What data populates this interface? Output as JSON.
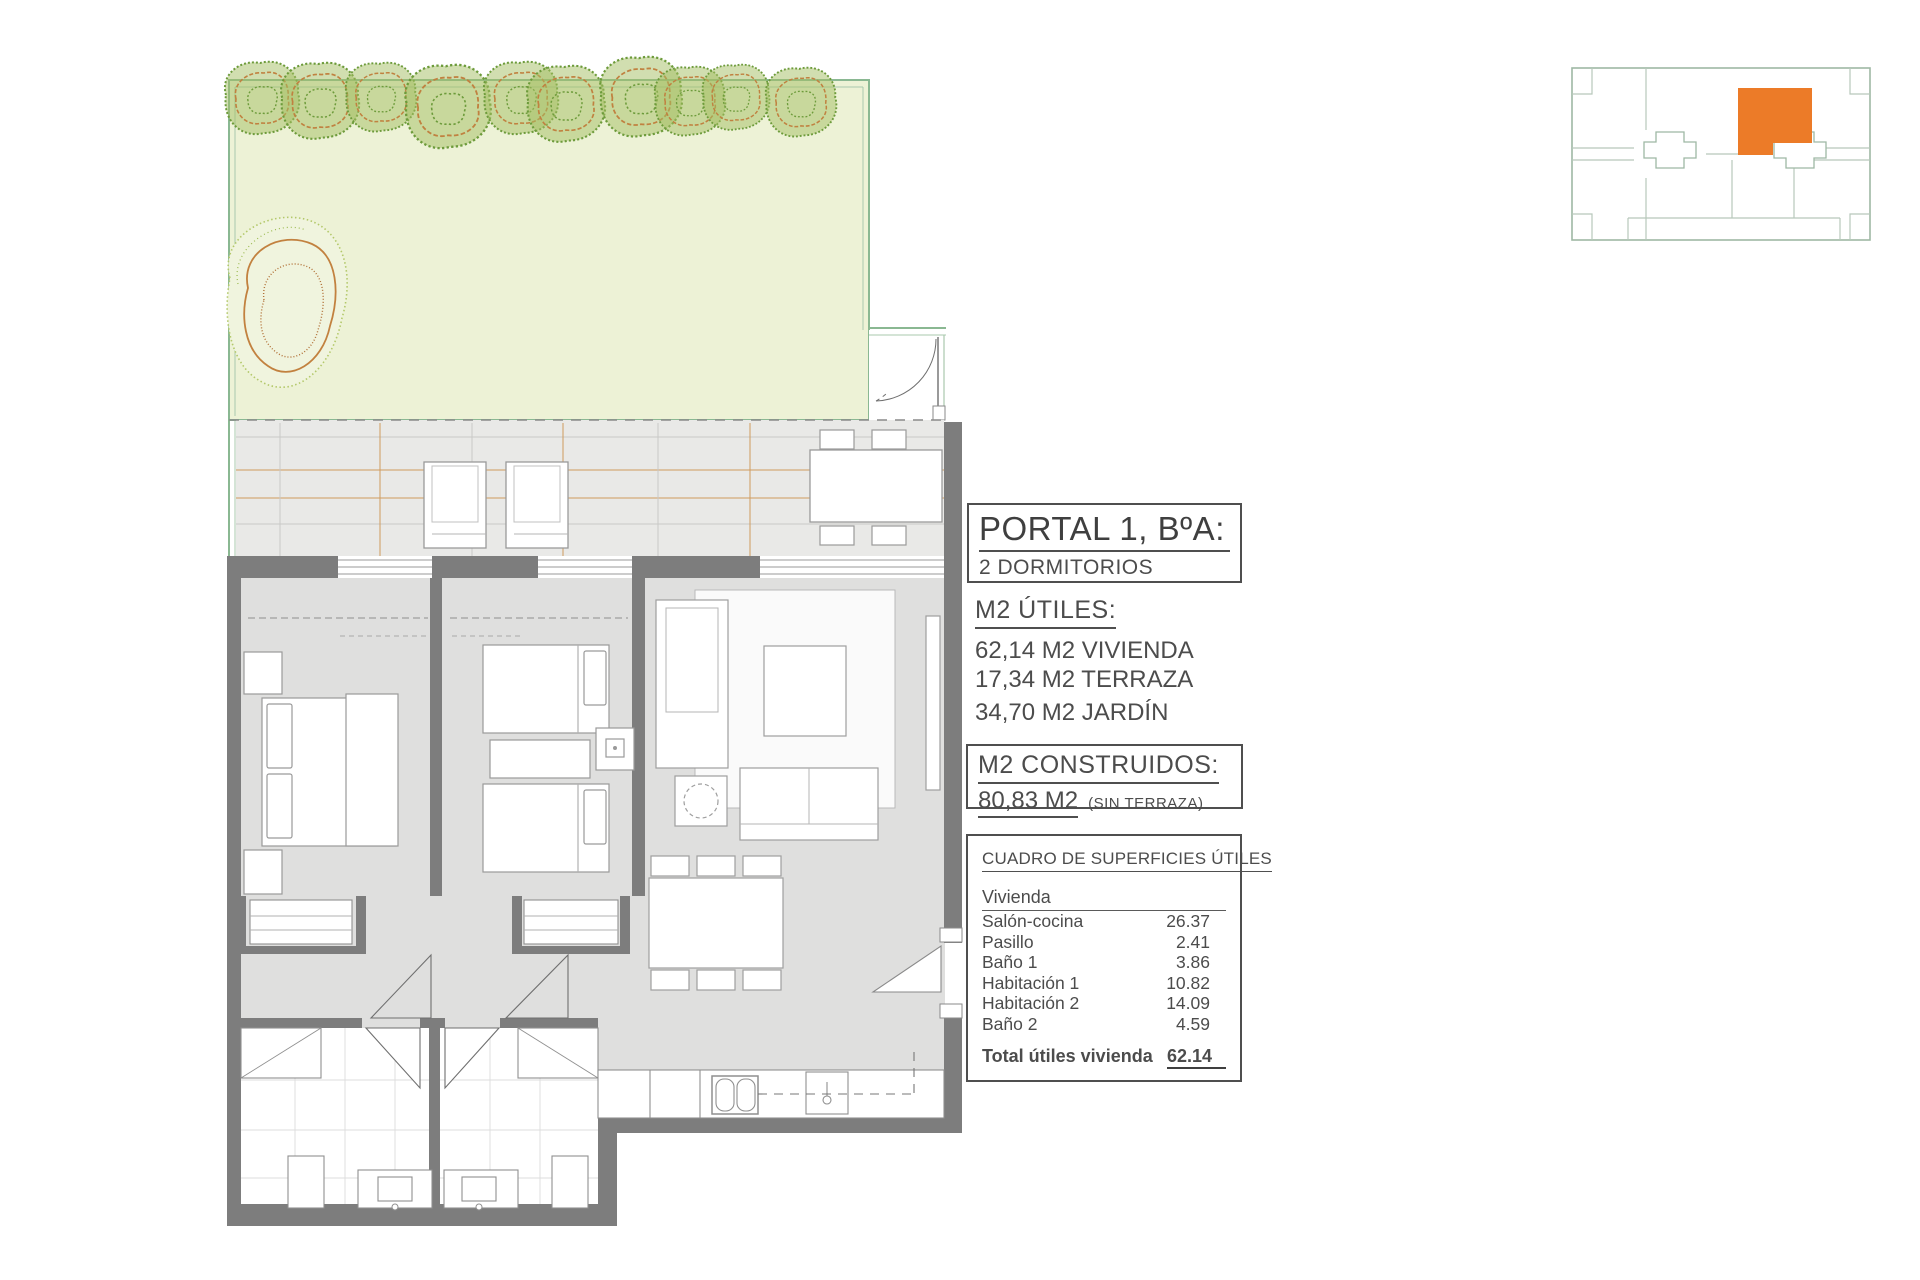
{
  "title_block": {
    "title": "PORTAL 1, BºA:",
    "subtitle": "2 DORMITORIOS"
  },
  "m2_utiles": {
    "heading": "M2 ÚTILES:",
    "items": [
      "62,14 M2 VIVIENDA",
      "17,34 M2 TERRAZA",
      "34,70 M2 JARDÍN"
    ]
  },
  "m2_construidos": {
    "heading": "M2 CONSTRUIDOS:",
    "value": "80,83 M2",
    "note": "(SIN TERRAZA)"
  },
  "surface_table": {
    "heading": "CUADRO DE SUPERFICIES ÚTILES",
    "group": "Vivienda",
    "rows": [
      {
        "label": "Salón-cocina",
        "value": "26.37"
      },
      {
        "label": "Pasillo",
        "value": "2.41"
      },
      {
        "label": "Baño 1",
        "value": "3.86"
      },
      {
        "label": "Habitación 1",
        "value": "10.82"
      },
      {
        "label": "Habitación 2",
        "value": "14.09"
      },
      {
        "label": "Baño 2",
        "value": "4.59"
      }
    ],
    "total_label": "Total útiles vivienda",
    "total_value": "62.14"
  },
  "colors": {
    "highlight_orange": "#EC7B28",
    "garden_fill": "#EDF2D6",
    "garden_border": "#8AB892",
    "wall_gray": "#7D7D7D",
    "terrace_fill": "#E9E9E7",
    "decking_orange": "#CF9A5E",
    "room_fill": "#DFDFDE",
    "text_gray": "#4C4C4C"
  }
}
